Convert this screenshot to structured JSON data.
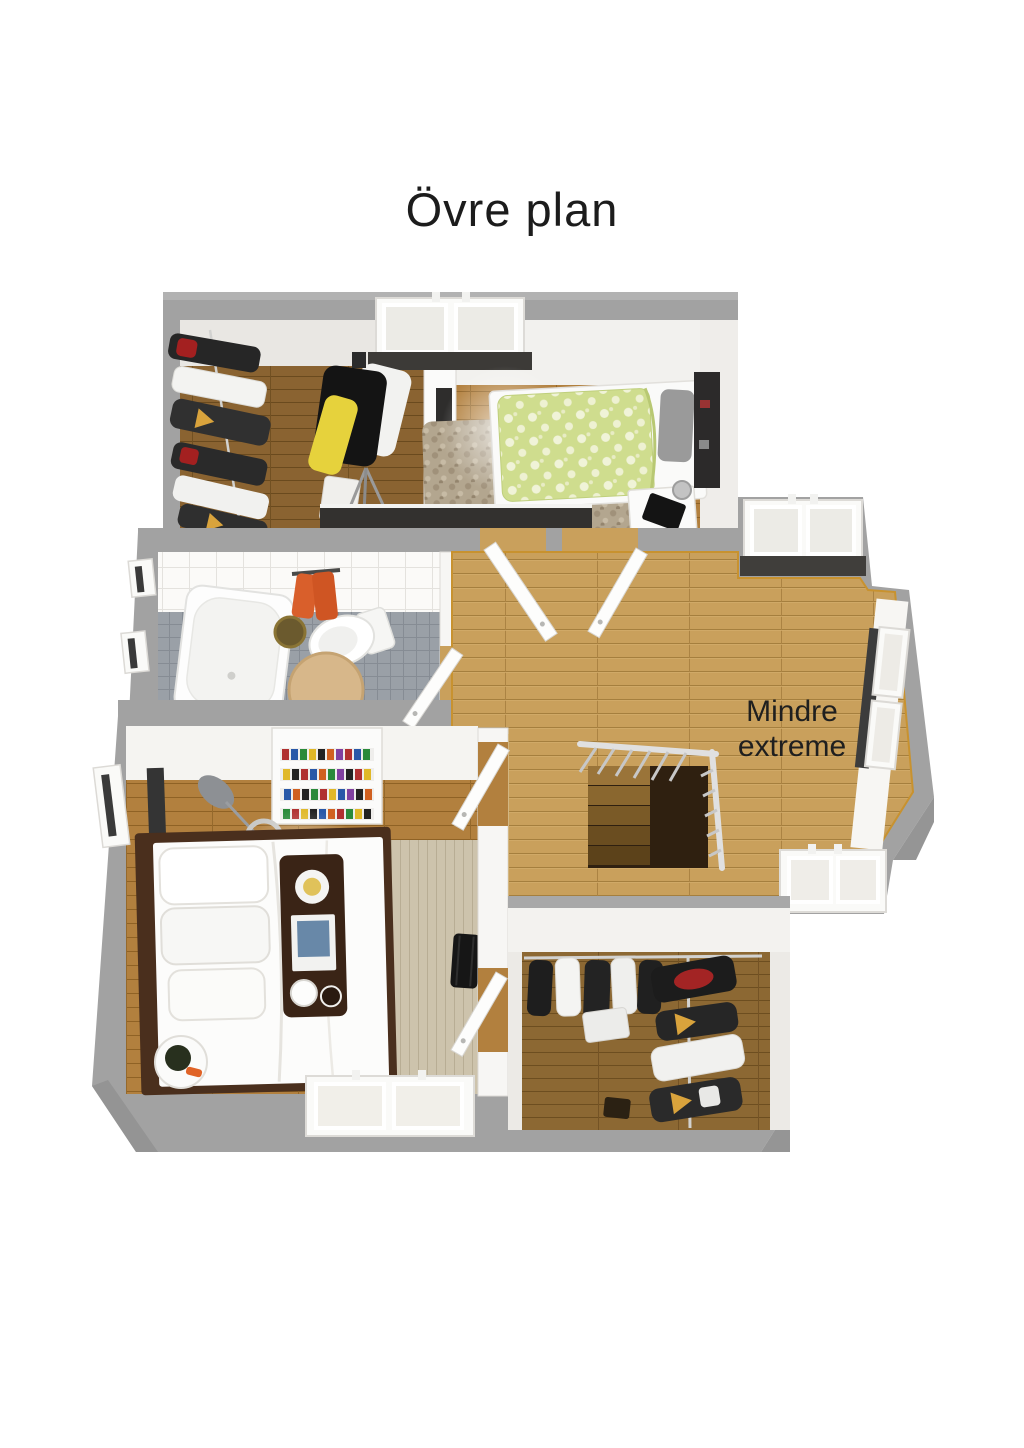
{
  "title": "Övre plan",
  "plan": {
    "room_label": "Mindre extreme",
    "colors": {
      "wall_gray": "#a2a2a2",
      "wall_face": "#f4f3f0",
      "floor_oak_hall": "#c9a05c",
      "floor_oak_bedroom": "#b2803e",
      "floor_oak_closet": "#8c6833",
      "bath_floor_tile": "#9aa0a7",
      "bath_wall_tile": "#fbfaf8",
      "duvet_green": "#cfdd8e",
      "towel_orange": "#d95f2b",
      "hanger_yellow": "#d9a33c",
      "stair_rail_gray": "#d8d8d8",
      "text": "#1f1f1f"
    }
  }
}
